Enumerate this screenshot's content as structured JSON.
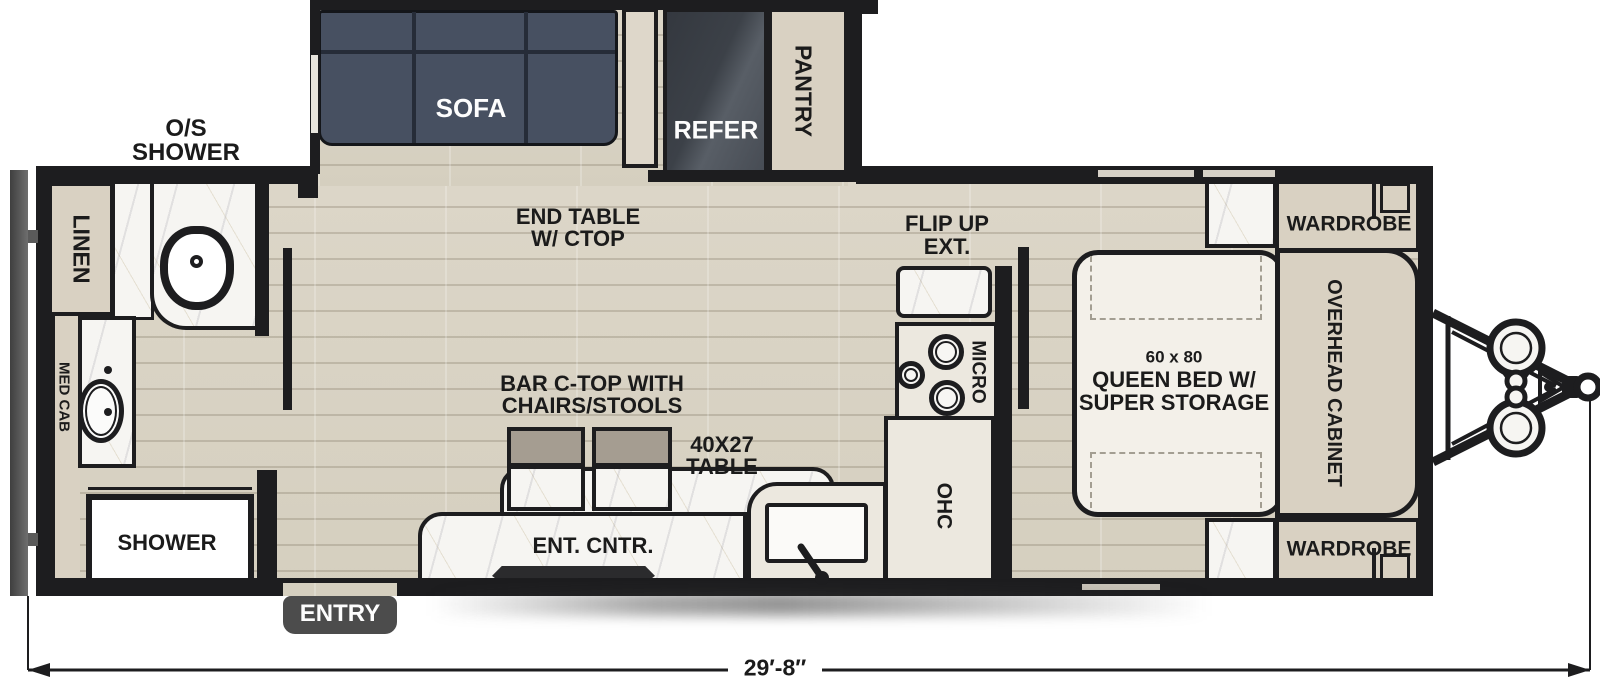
{
  "bath": {
    "os_shower_l1": "O/S",
    "os_shower_l2": "SHOWER",
    "linen": "LINEN",
    "med_cab": "MED CAB",
    "shower": "SHOWER"
  },
  "living": {
    "sofa": "SOFA",
    "end_table_l1": "END TABLE",
    "end_table_l2": "W/ CTOP",
    "bar_l1": "BAR C-TOP WITH",
    "bar_l2": "CHAIRS/STOOLS",
    "table_l1": "40X27",
    "table_l2": "TABLE",
    "ent_cntr": "ENT. CNTR.",
    "entry": "ENTRY"
  },
  "kitchen": {
    "refer": "REFER",
    "pantry": "PANTRY",
    "flip_l1": "FLIP UP",
    "flip_l2": "EXT.",
    "micro": "MICRO",
    "ohc": "OHC"
  },
  "bedroom": {
    "bed_l1": "60 x 80",
    "bed_l2": "QUEEN BED W/",
    "bed_l3": "SUPER STORAGE",
    "wardrobe_top": "WARDROBE",
    "wardrobe_bottom": "WARDROBE",
    "overhead_cabinet": "OVERHEAD CABINET"
  },
  "dimensions": {
    "overall_length": "29′-8″"
  },
  "colors": {
    "wall": "#1d1d1f",
    "floor_wood": "#d9d3c5",
    "cabinet_tan": "#d9d1c2",
    "counter_cream": "#ece8df",
    "marble": "#f6f5f2",
    "sofa": "#475061",
    "refrigerator": "#3a3f48",
    "chair": "#a59d91",
    "entry_step": "#4c4c4c"
  }
}
